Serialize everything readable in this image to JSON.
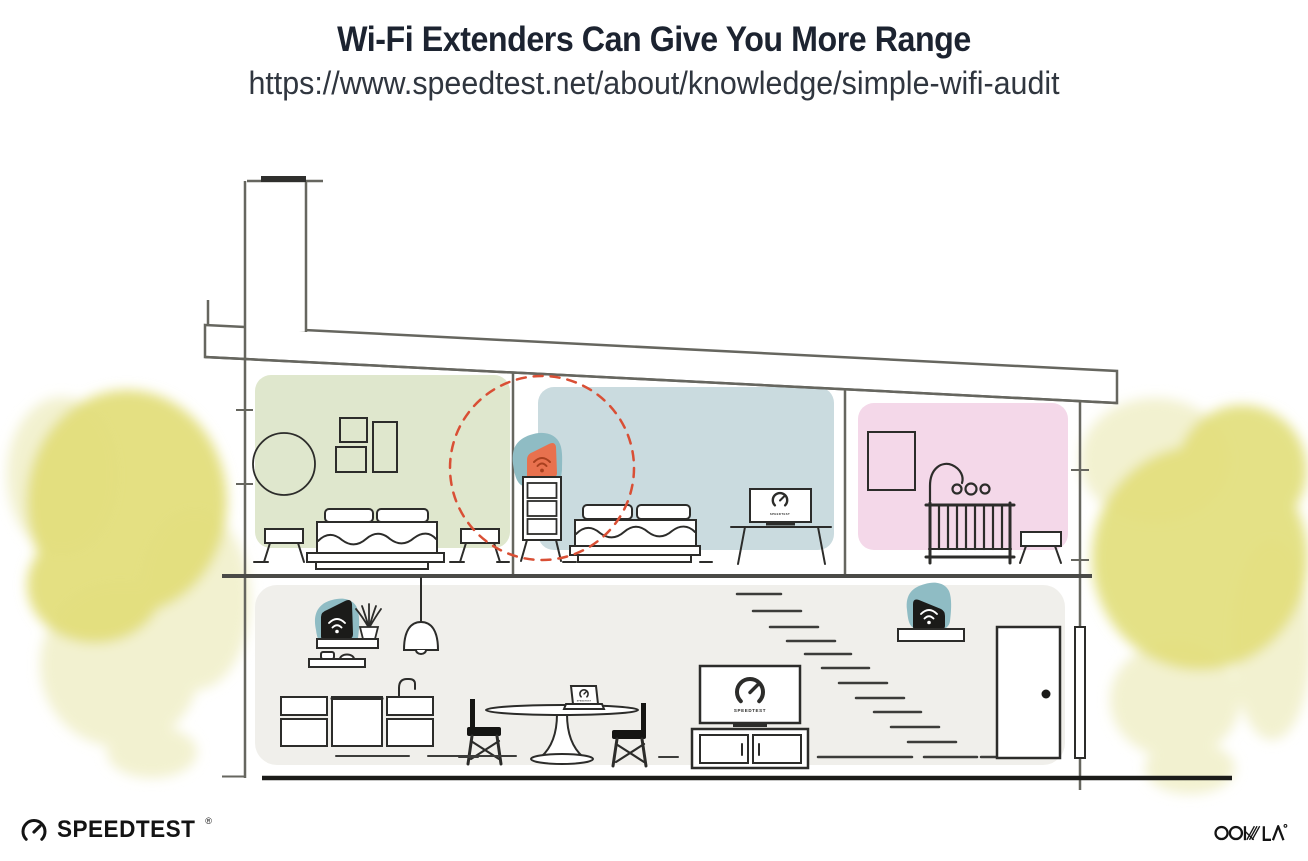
{
  "header": {
    "title": "Wi-Fi Extenders Can Give You More Range",
    "url": "https://www.speedtest.net/about/knowledge/simple-wifi-audit"
  },
  "illustration": {
    "screen_label": "SPEEDTEST",
    "colors": {
      "room_green": "#dfe7cd",
      "room_blue": "#cadbdf",
      "room_pink": "#f4d8e9",
      "floor_gray": "#f0efeb",
      "device_teal": "#8fbcc4",
      "device_orange": "#e8714e",
      "device_orange_dark": "#a8401f",
      "device_black": "#1b1b19",
      "coverage_red": "#d94f35",
      "foliage_strong": "#e2de79",
      "foliage_pale": "#eeecc1",
      "line_dark": "#2c2c2a",
      "line_gray": "#66665f"
    },
    "icons": {
      "extender_bedroom": "wifi-icon",
      "extender_kitchen": "wifi-icon",
      "extender_stairs": "wifi-icon",
      "tv_screens": "speedtest-gauge-icon"
    }
  },
  "footer": {
    "speedtest_text": "SPEEDTEST",
    "speedtest_trademark": "®",
    "ookla_text": "OOKLA"
  }
}
